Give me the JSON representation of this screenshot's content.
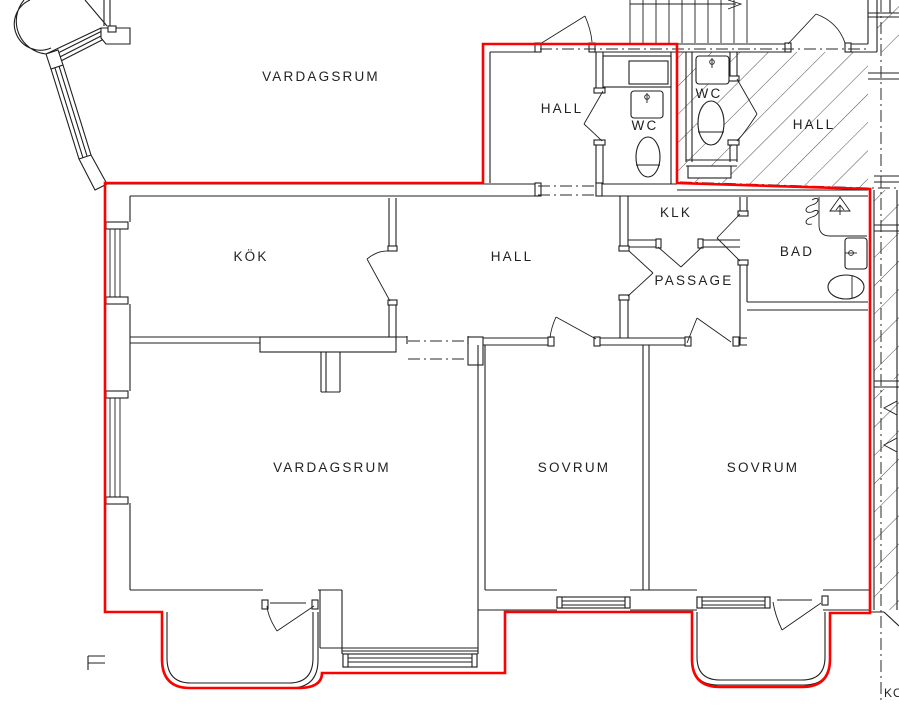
{
  "drawing_type": "apartment-floor-plan",
  "colors": {
    "boundary": "#fe0000",
    "line": "#1f1f1f",
    "background": "#ffffff"
  },
  "rooms": [
    {
      "label": "VARDAGSRUM"
    },
    {
      "label": "HALL"
    },
    {
      "label": "WC"
    },
    {
      "label": "WC"
    },
    {
      "label": "HALL"
    },
    {
      "label": "KÖK"
    },
    {
      "label": "HALL"
    },
    {
      "label": "KLK"
    },
    {
      "label": "PASSAGE"
    },
    {
      "label": "BAD"
    },
    {
      "label": "VARDAGSRUM"
    },
    {
      "label": "SOVRUM"
    },
    {
      "label": "SOVRUM"
    }
  ],
  "edge_text": {
    "label": "KON"
  },
  "fixtures": [
    "toilet",
    "sink",
    "radiator-coil",
    "supply-air-triangle",
    "shower-screen",
    "stair-direction-arrow",
    "window",
    "door-swing"
  ],
  "legend": {
    "red_outline_meaning": "apartment boundary",
    "hatched_area_meaning": "outside apartment / stairwell"
  }
}
